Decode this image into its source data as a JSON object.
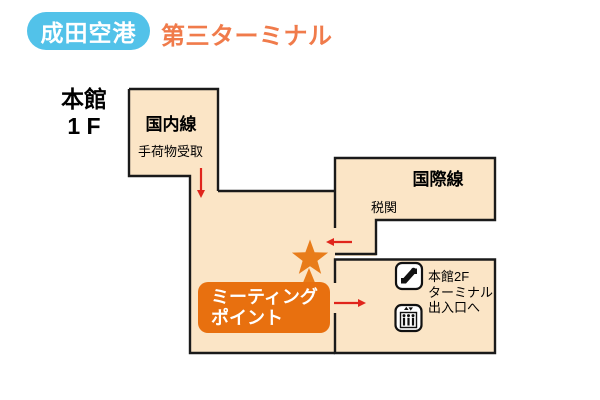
{
  "header": {
    "airport_name": "成田空港",
    "terminal_name": "第三ターミナル"
  },
  "map": {
    "building_label": "本館\n1 F",
    "domestic": {
      "title": "国内線",
      "subtitle": "手荷物受取"
    },
    "international": {
      "title": "国際線",
      "subtitle": "税関"
    },
    "exit_info": {
      "text": "本館2F\nターミナル\n出入口へ"
    },
    "meeting_point": {
      "label": "ミーティング\nポイント"
    },
    "icons": {
      "escalator": "escalator-icon",
      "elevator": "elevator-icon",
      "marker": "meeting-point-star-icon"
    },
    "colors": {
      "floor_fill": "#FBE5C6",
      "wall": "#1A1A1A",
      "badge_blue": "#52C2E9",
      "title_orange": "#F07B4B",
      "meeting_orange": "#E8700F",
      "star_orange": "#E87C1A",
      "arrow_red": "#E0251C"
    }
  }
}
